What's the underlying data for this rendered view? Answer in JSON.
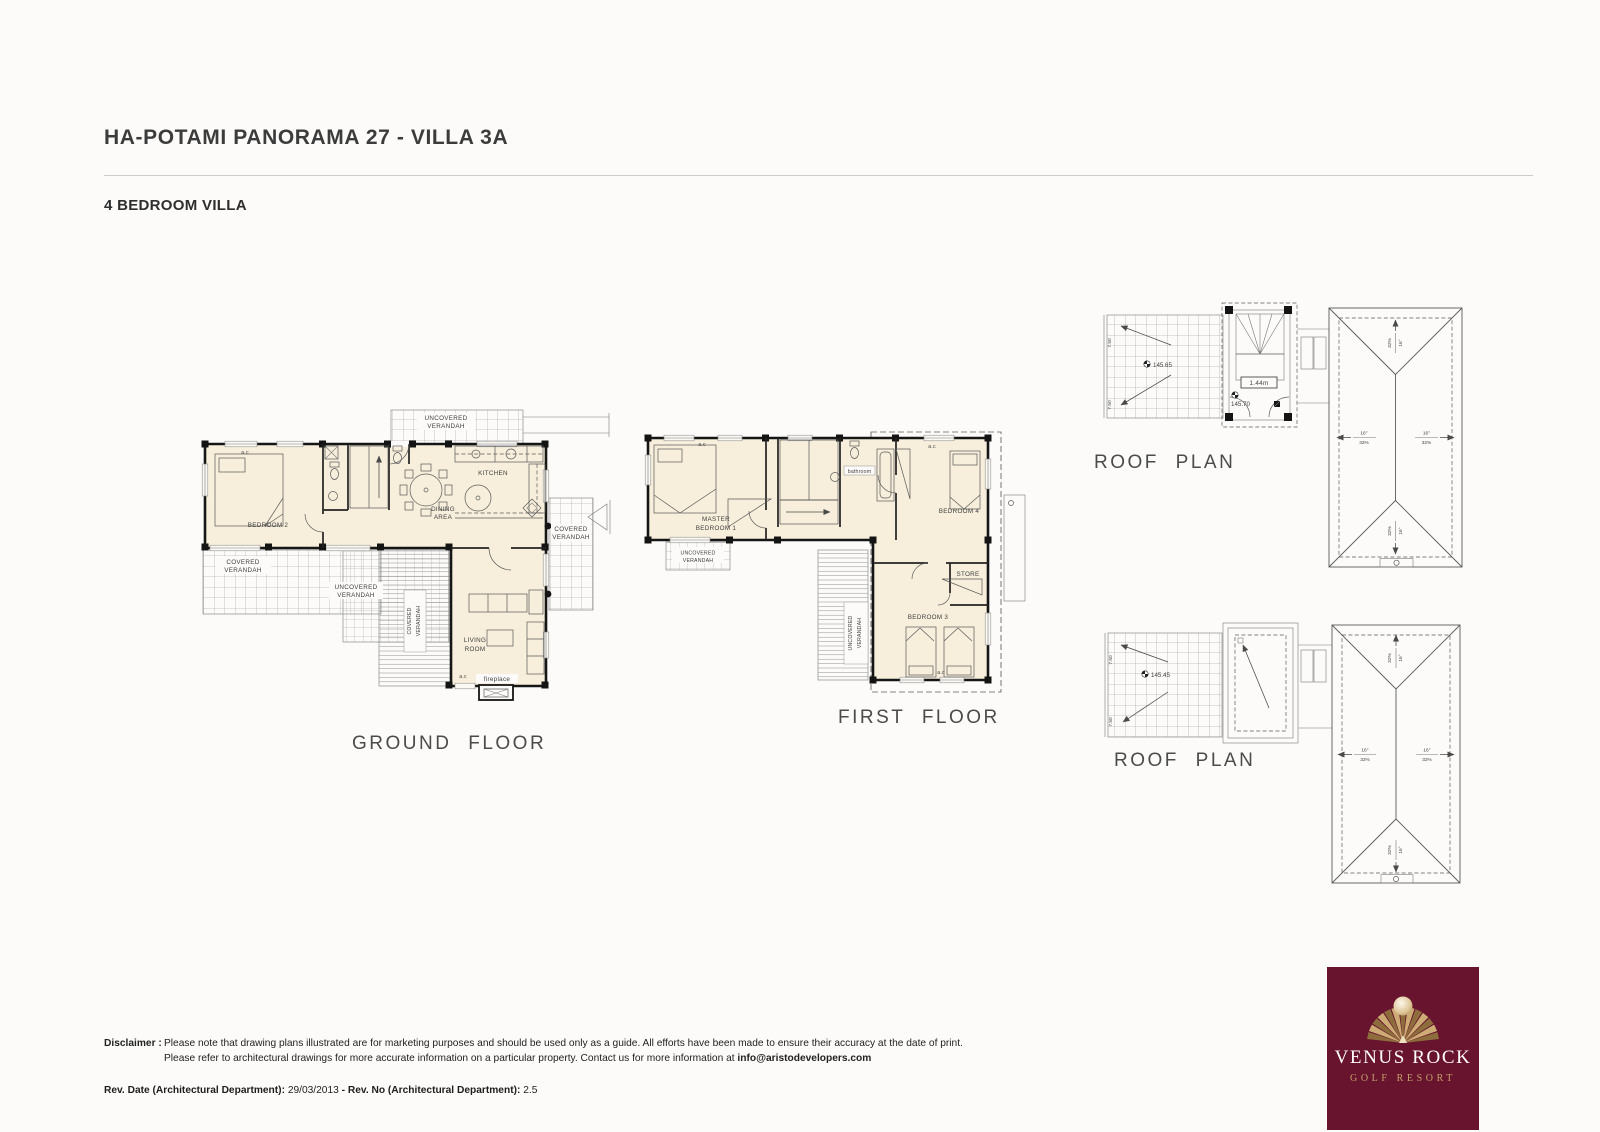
{
  "page": {
    "title": "HA-POTAMI PANORAMA 27 - VILLA 3A",
    "subtitle": "4 BEDROOM VILLA"
  },
  "ground": {
    "label": "GROUND FLOOR",
    "uv1": "UNCOVERED",
    "uv2": "VERANDAH",
    "cv1": "COVERED",
    "cv2": "VERANDAH",
    "bedroom2": "BEDROOM 2",
    "kitchen": "KITCHEN",
    "dining1": "DINING",
    "dining2": "AREA",
    "living1": "LIVING",
    "living2": "ROOM",
    "fireplace": "fireplace",
    "ac": "a.c"
  },
  "first": {
    "label": "FIRST FLOOR",
    "master1": "MASTER",
    "master2": "BEDROOM 1",
    "bathroom": "bathroom",
    "bedroom4": "BEDROOM 4",
    "bedroom3": "BEDROOM 3",
    "store": "STORE",
    "uv1": "UNCOVERED",
    "uv2": "VERANDAH",
    "ac": "a.c"
  },
  "roof1": {
    "label": "ROOF PLAN",
    "level_pergola": "145.65",
    "stair_dim": "1.44m",
    "level_stair": "145.70",
    "deg": "16°",
    "pct": "32%",
    "dim": "7.50"
  },
  "roof2": {
    "label": "ROOF PLAN",
    "level_pergola": "145.45",
    "deg": "16°",
    "pct": "32%",
    "dim": "7.50"
  },
  "footer": {
    "disclaimer_label": "Disclaimer :",
    "line1": "Please note that drawing plans illustrated are for marketing purposes and should be used only as a guide. All efforts have been made to ensure their accuracy at the date of print.",
    "line2": "Please refer to architectural drawings for more accurate information on a particular property. Contact us for more information at ",
    "email": "info@aristodevelopers.com",
    "rev_date_label": "Rev. Date (Architectural Department):",
    "rev_date": "29/03/2013",
    "rev_sep": "-",
    "rev_no_label": "Rev. No (Architectural Department):",
    "rev_no": "2.5"
  },
  "logo": {
    "line1": "VENUS ROCK",
    "line2": "GOLF RESORT",
    "bg_color": "#69142e",
    "gold_color": "#c3a06b"
  }
}
